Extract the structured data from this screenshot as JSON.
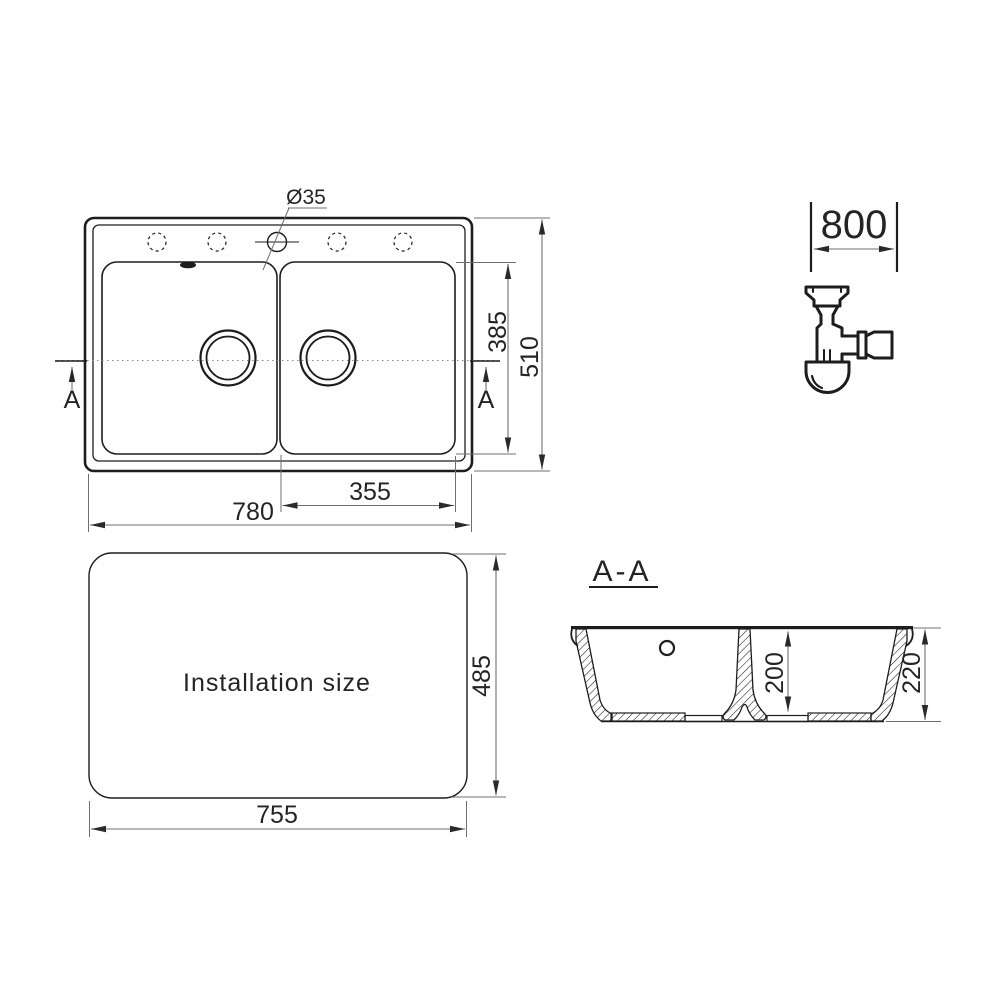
{
  "colors": {
    "object_line": "#1d1d1b",
    "dim_line": "#6f6f6f",
    "text": "#242424",
    "background": "#ffffff"
  },
  "top_view": {
    "dim_overall_width": "780",
    "dim_overall_depth": "510",
    "dim_bowl_length": "385",
    "dim_right_bowl_width": "355",
    "dim_faucet_hole": "Ø35",
    "section_marker_left": "A",
    "section_marker_right": "A"
  },
  "siphon": {
    "dim_cabinet_width": "800"
  },
  "installation": {
    "caption": "Installation size",
    "dim_width": "755",
    "dim_depth": "485"
  },
  "section": {
    "caption": "A-A",
    "dim_bowl_depth": "200",
    "dim_overall_depth": "220"
  }
}
